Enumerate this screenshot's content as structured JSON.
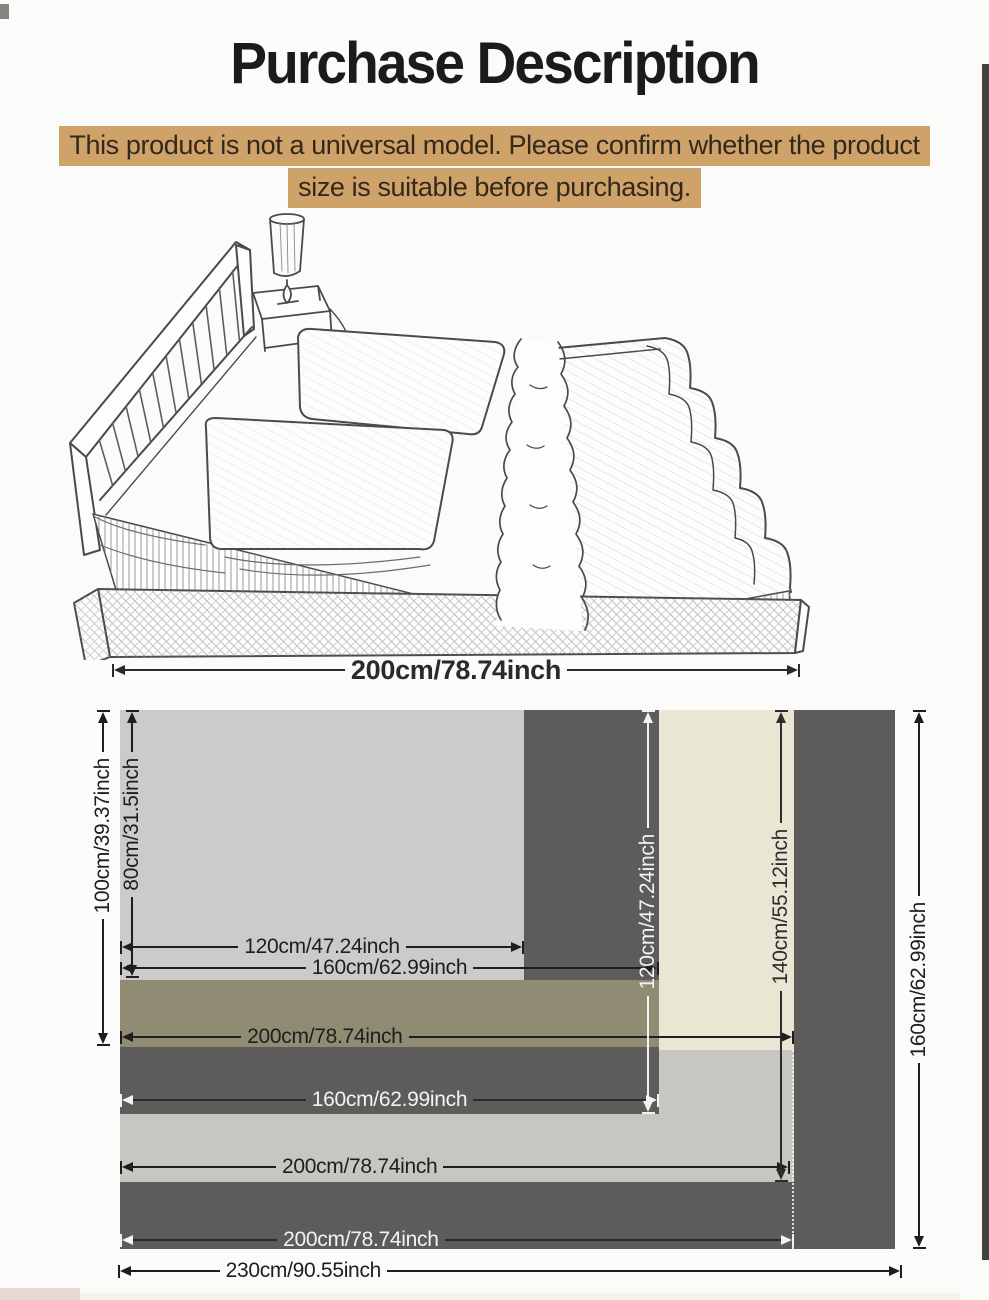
{
  "title": "Purchase Description",
  "warning": {
    "line1": "This product is not a universal model. Please confirm whether the product",
    "line2": "size is suitable before purchasing.",
    "bg_color": "#cfa26a"
  },
  "bed_illustration": {
    "description": "hand-drawn pencil sketch of a double bed with slatted headboard, two stacked pillows, ruffled bedspread, nightstand and cylindrical lamp",
    "width_dim": {
      "label": "200cm/78.74inch"
    }
  },
  "size_diagram": {
    "colors": {
      "dark_gray": "#5d5c5a",
      "light_gray": "#cbcbc9",
      "light_gray_2": "#c6c7c2",
      "olive": "#8f8c73",
      "cream": "#e9e7d3"
    },
    "horizontal_dims": [
      {
        "id": "w120",
        "label": "120cm/47.24inch",
        "text_color": "dark"
      },
      {
        "id": "w160a",
        "label": "160cm/62.99inch",
        "text_color": "dark"
      },
      {
        "id": "w200a",
        "label": "200cm/78.74inch",
        "text_color": "dark"
      },
      {
        "id": "w160b",
        "label": "160cm/62.99inch",
        "text_color": "white"
      },
      {
        "id": "w200b",
        "label": "200cm/78.74inch",
        "text_color": "dark"
      },
      {
        "id": "w200c",
        "label": "200cm/78.74inch",
        "text_color": "white"
      },
      {
        "id": "w230",
        "label": "230cm/90.55inch",
        "text_color": "dark"
      }
    ],
    "vertical_dims": [
      {
        "id": "h100",
        "label": "100cm/39.37inch",
        "text_color": "dark"
      },
      {
        "id": "h80",
        "label": "80cm/31.5inch",
        "text_color": "dark"
      },
      {
        "id": "h120",
        "label": "120cm/47.24inch",
        "text_color": "white"
      },
      {
        "id": "h140",
        "label": "140cm/55.12inch",
        "text_color": "dark"
      },
      {
        "id": "h160",
        "label": "160cm/62.99inch",
        "text_color": "dark"
      }
    ]
  }
}
